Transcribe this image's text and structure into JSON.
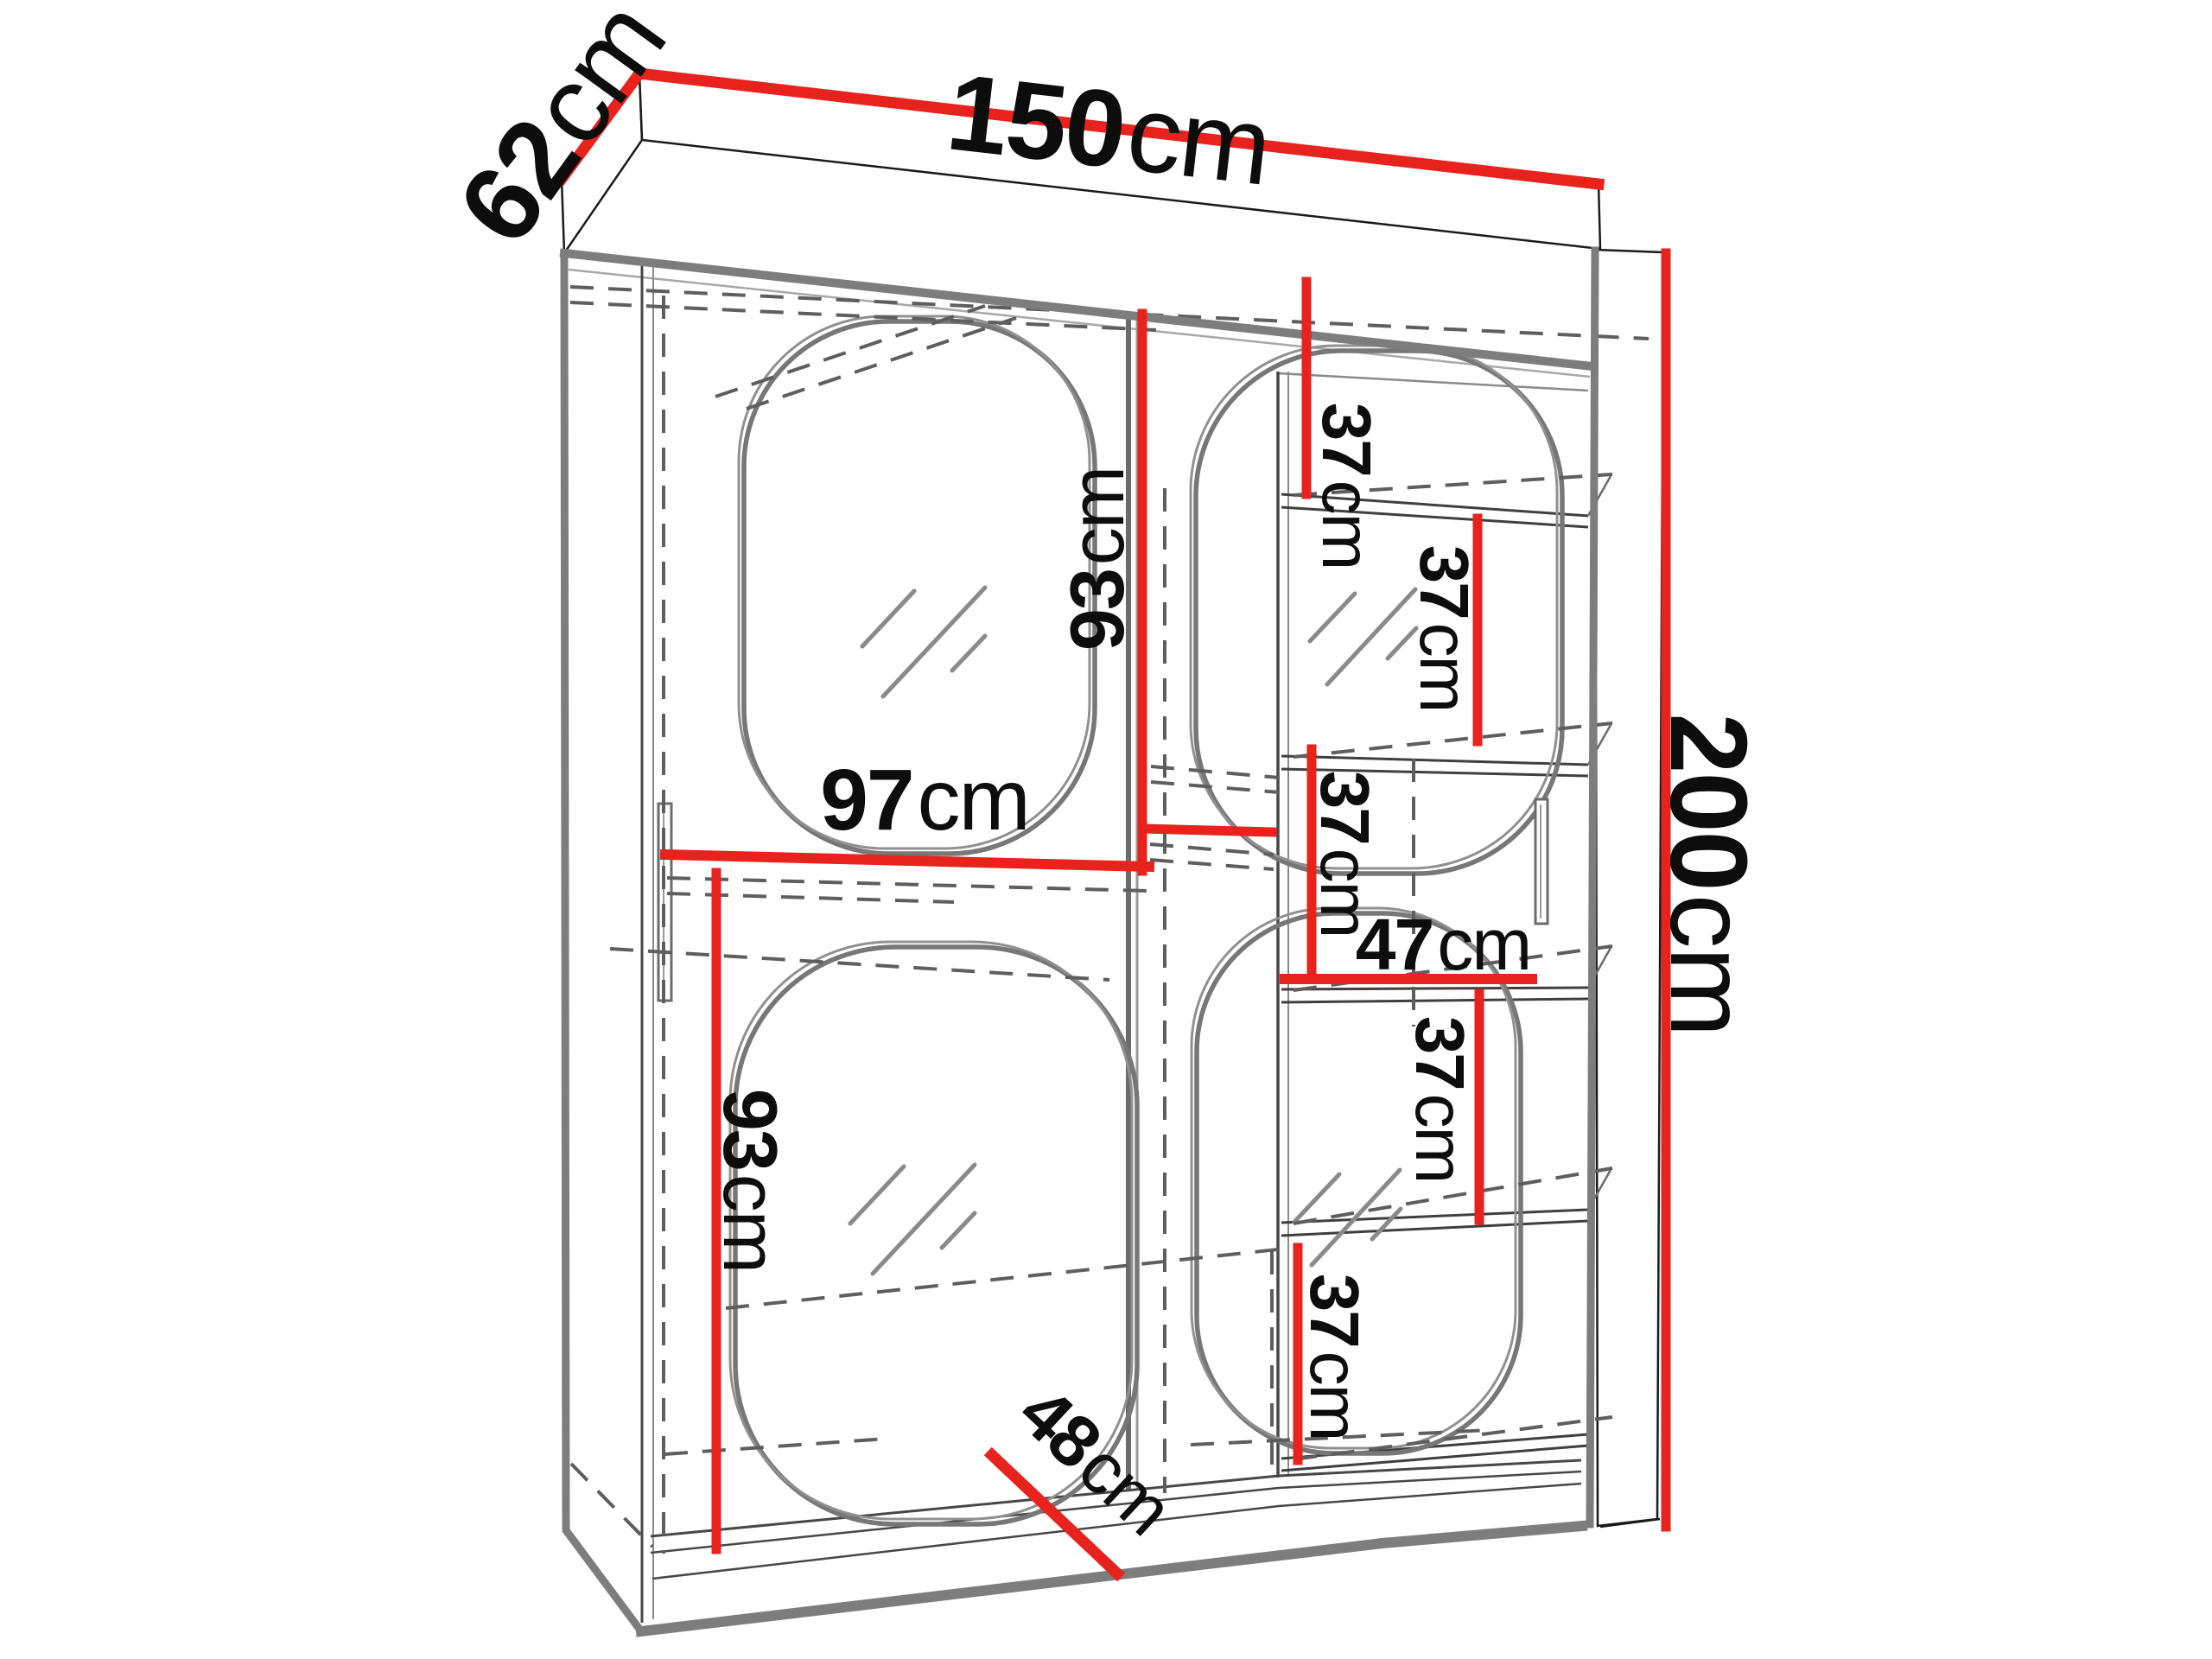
{
  "diagram": {
    "title": "wardrobe-dimension-drawing",
    "furniture": "two-door sliding wardrobe with mirrors and shelf column"
  },
  "colors": {
    "accent": "#e8221c",
    "outline_dark": "#1a1a1a",
    "outline_gray": "#7d7d7d",
    "hidden_edge": "#5e5e5e"
  },
  "labels": {
    "width": {
      "value": "150",
      "unit": "cm"
    },
    "depth": {
      "value": "62",
      "unit": "cm"
    },
    "height": {
      "value": "200",
      "unit": "cm"
    },
    "left_interior_width": {
      "value": "97",
      "unit": "cm"
    },
    "center_mirror_height": {
      "value": "93",
      "unit": "cm"
    },
    "left_mirror_height": {
      "value": "93",
      "unit": "cm"
    },
    "shelf_column_width": {
      "value": "47",
      "unit": "cm"
    },
    "door_diagonal": {
      "value": "48",
      "unit": "cm"
    },
    "shelf_gap_1": {
      "value": "37",
      "unit": "cm"
    },
    "shelf_gap_2": {
      "value": "37",
      "unit": "cm"
    },
    "shelf_gap_3": {
      "value": "37",
      "unit": "cm"
    },
    "shelf_gap_4": {
      "value": "37",
      "unit": "cm"
    },
    "shelf_gap_5": {
      "value": "37",
      "unit": "cm"
    }
  }
}
